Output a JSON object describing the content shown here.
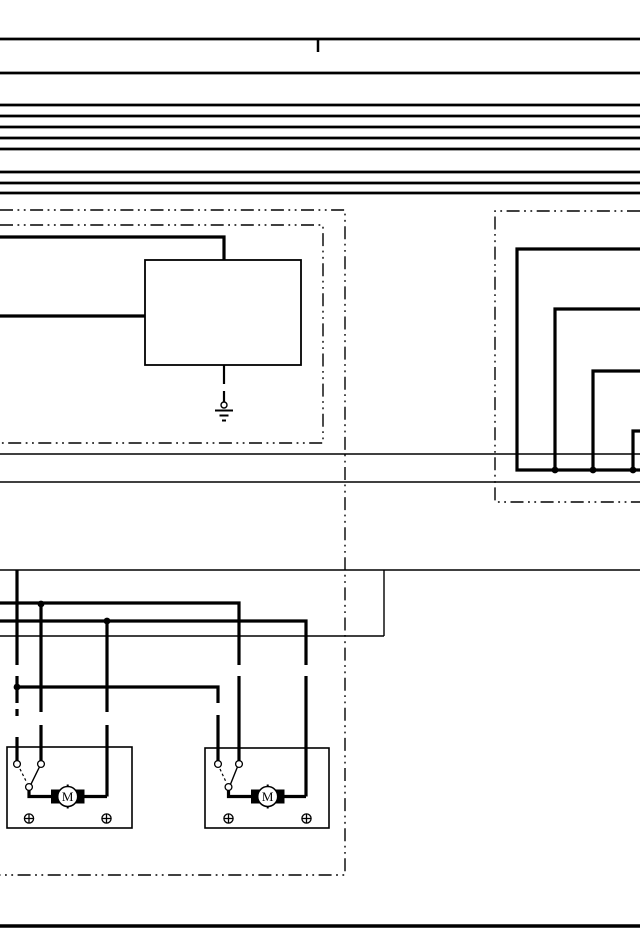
{
  "page": {
    "bg": "#ffffff",
    "ink": "#000000",
    "width": 640,
    "height": 950
  },
  "top_bus": {
    "ys": [
      39,
      73,
      105,
      116,
      127,
      138,
      149,
      172,
      183,
      193
    ],
    "x1": 0,
    "x2": 640,
    "tick": {
      "x": 318,
      "y1": 40,
      "y2": 52
    }
  },
  "bottom_rule": {
    "y": 926,
    "x1": 0,
    "x2": 640
  },
  "thin_wires": [
    [
      0,
      454,
      640,
      454
    ],
    [
      0,
      482,
      640,
      482
    ],
    [
      0,
      570,
      640,
      570
    ],
    [
      0,
      636,
      384,
      636
    ],
    [
      384,
      570,
      384,
      636
    ]
  ],
  "boundaries": [
    {
      "name": "left-outer-harness",
      "points": [
        [
          0,
          210
        ],
        [
          345,
          210
        ],
        [
          345,
          875
        ],
        [
          0,
          875
        ]
      ]
    },
    {
      "name": "left-inner-harness",
      "points": [
        [
          0,
          225
        ],
        [
          323,
          225
        ],
        [
          323,
          443
        ],
        [
          0,
          443
        ]
      ]
    },
    {
      "name": "right-harness",
      "points": [
        [
          640,
          211
        ],
        [
          495,
          211
        ],
        [
          495,
          502
        ],
        [
          640,
          502
        ]
      ]
    }
  ],
  "control_unit_box": {
    "x": 145,
    "y": 260,
    "w": 156,
    "h": 105
  },
  "thick_wires": [
    [
      [
        0,
        237
      ],
      [
        224,
        237
      ],
      [
        224,
        260
      ]
    ],
    [
      [
        0,
        316
      ],
      [
        145,
        316
      ]
    ],
    [
      [
        640,
        249
      ],
      [
        517,
        249
      ],
      [
        517,
        470
      ],
      [
        640,
        470
      ]
    ],
    [
      [
        640,
        309
      ],
      [
        555,
        309
      ],
      [
        555,
        470
      ]
    ],
    [
      [
        640,
        371
      ],
      [
        593,
        371
      ],
      [
        593,
        470
      ]
    ],
    [
      [
        640,
        431
      ],
      [
        633,
        431
      ],
      [
        633,
        470
      ]
    ],
    [
      [
        0,
        603
      ],
      [
        239,
        603
      ],
      [
        239,
        665
      ]
    ],
    [
      [
        239,
        676
      ],
      [
        239,
        760.5
      ]
    ],
    [
      [
        0,
        621
      ],
      [
        306,
        621
      ],
      [
        306,
        665
      ]
    ],
    [
      [
        306,
        676
      ],
      [
        306,
        796.5
      ]
    ],
    [
      [
        17,
        570
      ],
      [
        17,
        665
      ]
    ],
    [
      [
        17,
        676
      ],
      [
        17,
        703
      ]
    ],
    [
      [
        17,
        709
      ],
      [
        17,
        716
      ]
    ],
    [
      [
        17,
        737
      ],
      [
        17,
        760.5
      ]
    ],
    [
      [
        41,
        604
      ],
      [
        41,
        712
      ]
    ],
    [
      [
        41,
        725
      ],
      [
        41,
        760.5
      ]
    ],
    [
      [
        107,
        621
      ],
      [
        107,
        712
      ]
    ],
    [
      [
        107,
        725
      ],
      [
        107,
        796.5
      ]
    ],
    [
      [
        17,
        687
      ],
      [
        218,
        687
      ],
      [
        218,
        703
      ]
    ],
    [
      [
        218,
        715
      ],
      [
        218,
        760.5
      ]
    ]
  ],
  "junction_dots": [
    [
      41,
      604
    ],
    [
      107,
      621
    ],
    [
      17,
      687
    ],
    [
      555,
      470
    ],
    [
      593,
      470
    ],
    [
      633,
      470
    ]
  ],
  "ground_symbol": {
    "leads": [
      [
        224,
        365,
        224,
        384
      ],
      [
        224,
        391,
        224,
        402
      ]
    ],
    "circle": {
      "cx": 224,
      "cy": 405,
      "r": 3
    },
    "bars": [
      [
        215,
        410.5,
        233,
        410.5
      ],
      [
        219.5,
        415.5,
        228.5,
        415.5
      ],
      [
        222,
        420.5,
        226,
        420.5
      ]
    ]
  },
  "motor_units": [
    {
      "label": "M",
      "box": {
        "x": 7,
        "y": 747,
        "w": 125,
        "h": 81
      },
      "contacts": [
        [
          17,
          764
        ],
        [
          41,
          764
        ]
      ],
      "common_contact": [
        29,
        787
      ],
      "switch_arm": [
        39.5,
        766.8,
        31,
        784.2
      ],
      "linkage_dash": [
        20,
        769,
        27,
        783
      ],
      "feed_wire": [
        [
          29,
          790
        ],
        [
          29,
          796.5
        ],
        [
          51,
          796.5
        ]
      ],
      "output_wire": [
        [
          84.5,
          796.5
        ],
        [
          107,
          796.5
        ]
      ],
      "brushes": [
        {
          "x": 51,
          "y": 789.5,
          "w": 8.5,
          "h": 14
        },
        {
          "x": 76,
          "y": 789.5,
          "w": 8.5,
          "h": 14
        }
      ],
      "motor_circle": {
        "cx": 67.7,
        "cy": 796.5,
        "r": 10
      },
      "screw_terminals": [
        [
          29,
          818.5
        ],
        [
          106.5,
          818.5
        ]
      ]
    },
    {
      "label": "M",
      "box": {
        "x": 205,
        "y": 748,
        "w": 124,
        "h": 80
      },
      "contacts": [
        [
          218,
          764
        ],
        [
          239,
          764
        ]
      ],
      "common_contact": [
        228.5,
        787
      ],
      "switch_arm": [
        237.5,
        766.8,
        230.5,
        784.2
      ],
      "linkage_dash": [
        220,
        769,
        226.5,
        783
      ],
      "feed_wire": [
        [
          228.5,
          790
        ],
        [
          228.5,
          796.5
        ],
        [
          251,
          796.5
        ]
      ],
      "output_wire": [
        [
          284.5,
          796.5
        ],
        [
          306,
          796.5
        ]
      ],
      "brushes": [
        {
          "x": 251,
          "y": 789.5,
          "w": 8.5,
          "h": 14
        },
        {
          "x": 276,
          "y": 789.5,
          "w": 8.5,
          "h": 14
        }
      ],
      "motor_circle": {
        "cx": 267.7,
        "cy": 796.5,
        "r": 10
      },
      "screw_terminals": [
        [
          228.5,
          818.5
        ],
        [
          306.5,
          818.5
        ]
      ]
    }
  ],
  "style": {
    "bus_sw": 2.7,
    "wire_sw": 3.2,
    "thin_sw": 1.4,
    "boundary_sw": 1.4,
    "boundary_dash": "13 4.5 1.8 4.5 1.8 4.5",
    "box_sw": 1.8,
    "motor_box_sw": 1.6,
    "dot_r": 3.4,
    "contact_r": 3.4,
    "screw_r": 4.6,
    "rule_sw": 3.4,
    "tick_sw": 2.5,
    "ground_lead_sw": 2.2,
    "ground_bar_sw": 2,
    "arm_sw": 1.4,
    "link_dash": "2.6 2.6"
  }
}
